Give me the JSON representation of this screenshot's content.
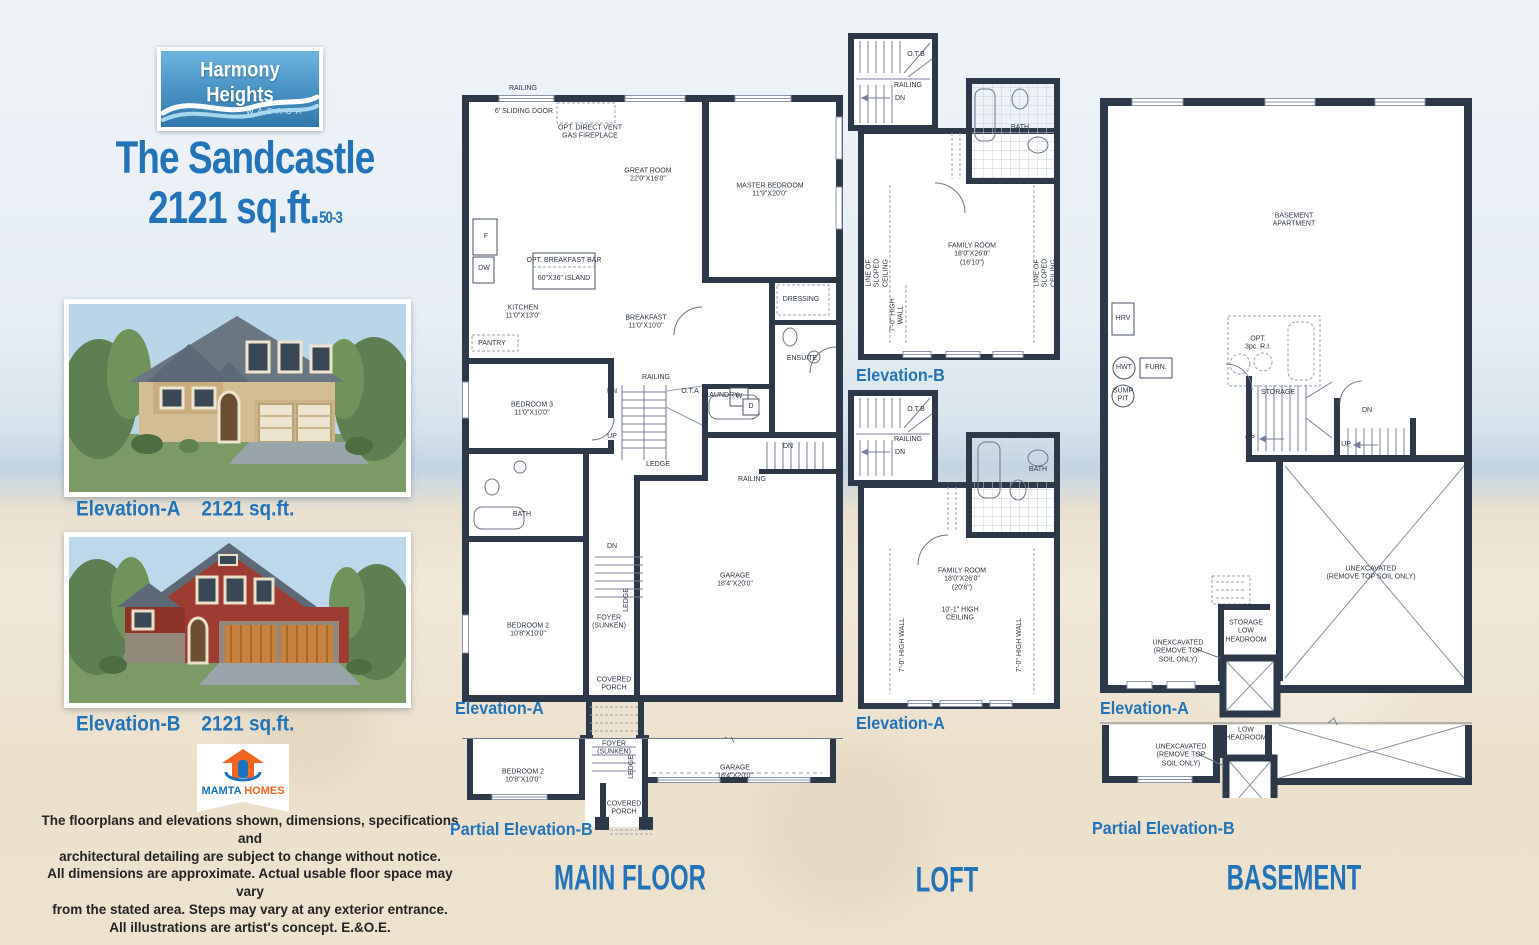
{
  "branding": {
    "logo_title": "Harmony Heights",
    "logo_subtitle": "WASAGA",
    "model_name": "The Sandcastle",
    "model_size": "2121 sq.ft.",
    "model_code": "50-3"
  },
  "elevations": {
    "a_caption": "Elevation-A",
    "a_size": "2121 sq.ft.",
    "b_caption": "Elevation-B",
    "b_size": "2121 sq.ft."
  },
  "builder": {
    "name_a": "MAMTA",
    "name_b": "HOMES"
  },
  "disclaimer": "The floorplans and elevations shown, dimensions, specifications and\narchitectural detailing are subject to change without notice.\nAll dimensions are approximate. Actual usable floor space may vary\nfrom the stated area. Steps may vary at any exterior entrance.\nAll illustrations are artist's concept. E.&O.E.",
  "floors": {
    "main": {
      "title": "MAIN FLOOR",
      "elevation_label": "Elevation-A",
      "partial_label": "Partial Elevation-B",
      "labels": {
        "railing": "RAILING",
        "sliding_door": "6' SLIDING DOOR",
        "fireplace": "OPT. DIRECT VENT\nGAS FIREPLACE",
        "great_room": "GREAT ROOM\n22'0\"X16'0\"",
        "master_bedroom": "MASTER BEDROOM\n11'9\"X20'0\"",
        "fridge": "F",
        "dishwasher": "DW",
        "breakfast_bar": "OPT. BREAKFAST BAR",
        "island": "60\"X36\" ISLAND",
        "kitchen": "KITCHEN\n11'0\"X13'0\"",
        "pantry": "PANTRY",
        "breakfast": "BREAKFAST\n11'0\"X10'0\"",
        "dressing": "DRESSING",
        "ensuite": "ENSUITE",
        "bedroom3": "BEDROOM 3\n11'0\"X10'0\"",
        "ota": "O.T.A",
        "laundry": "LAUNDRY",
        "washer": "W",
        "dryer": "D",
        "up": "UP",
        "dn": "DN",
        "ledge": "LEDGE",
        "bath": "BATH",
        "bedroom2": "BEDROOM 2\n10'8\"X10'0\"",
        "foyer": "FOYER\n(SUNKEN)",
        "garage": "GARAGE\n18'4\"X20'0\"",
        "covered_porch": "COVERED\nPORCH"
      }
    },
    "loft": {
      "title": "LOFT",
      "b_label": "Elevation-B",
      "a_label": "Elevation-A",
      "labels": {
        "otb": "O.T.B",
        "railing": "RAILING",
        "dn": "DN",
        "bath": "BATH",
        "family_b": "FAMILY ROOM\n18'0\"X26'0\"\n(16'10\")",
        "family_a": "FAMILY ROOM\n18'0\"X26'0\"\n(20'6\")",
        "sloped": "LINE OF\nSLOPED\nCEILING",
        "high_wall": "7'-0\" HIGH\nWALL",
        "high_wall_a": "7'-0\" HIGH WALL",
        "ceiling_a": "10'-1\" HIGH\nCEILING"
      }
    },
    "basement": {
      "title": "BASEMENT",
      "elevation_label": "Elevation-A",
      "partial_label": "Partial Elevation-B",
      "labels": {
        "apartment": "BASEMENT\nAPARTMENT",
        "hrv": "HRV",
        "hwt": "HWT",
        "furnace": "FURN.",
        "sump": "SUMP\nPIT",
        "opt_ri": "OPT.\n3pc. R.I.",
        "storage": "STORAGE",
        "up": "UP",
        "dn": "DN",
        "unexcavated": "UNEXCAVATED\n(REMOVE TOP SOIL ONLY)",
        "unexcavated_small": "UNEXCAVATED\n(REMOVE TOP\nSOIL ONLY)",
        "storage_low": "STORAGE\nLOW\nHEADROOM",
        "low_headroom": "LOW\nHEADROOM"
      }
    }
  }
}
